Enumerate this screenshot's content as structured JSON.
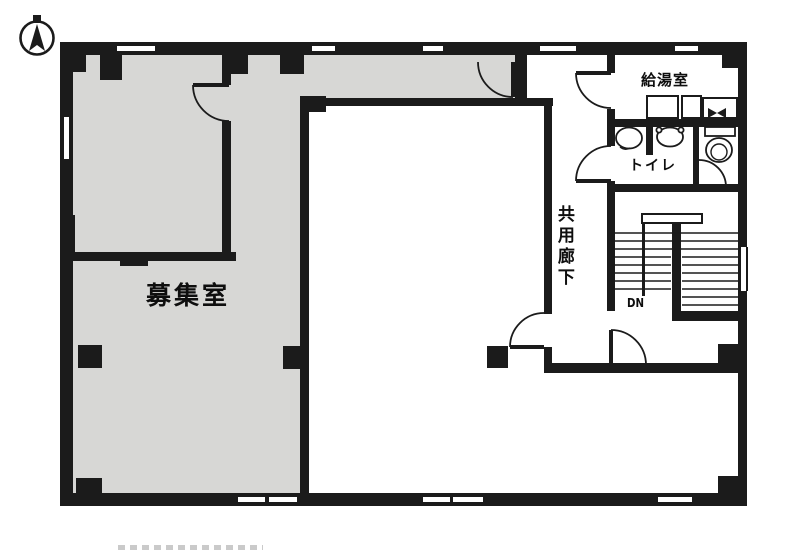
{
  "plan": {
    "labels": {
      "vacant_room": "募集室",
      "kitchenette": "給湯室",
      "toilet": "トイレ",
      "common_corridor": "共用廊下",
      "stairs_direction": "DN"
    },
    "icons": {
      "compass": "north-compass"
    },
    "colors": {
      "wall": "#1b1b1b",
      "vacant_room_fill": "#d7d7d5",
      "floor": "#ffffff"
    }
  }
}
